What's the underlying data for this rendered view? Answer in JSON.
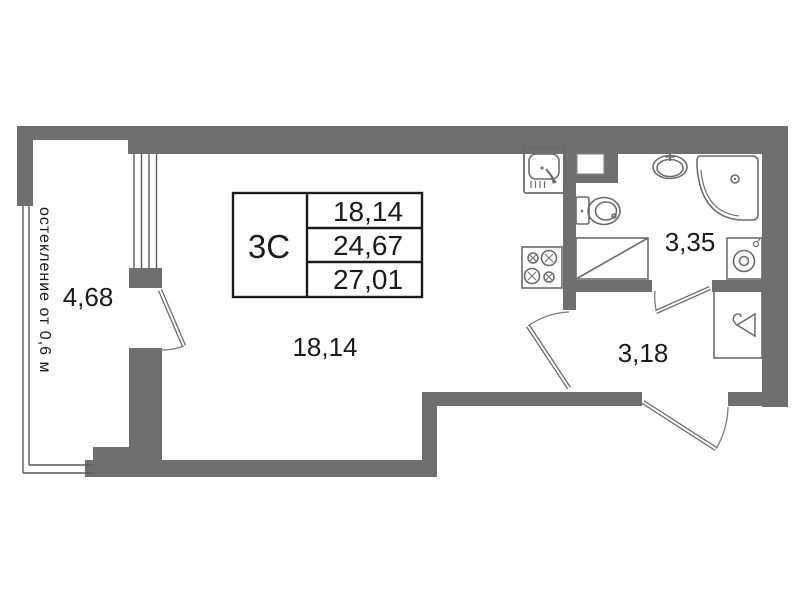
{
  "unit": {
    "code": "3С",
    "area_rows": [
      "18,14",
      "24,67",
      "27,01"
    ]
  },
  "rooms": {
    "balcony": "4,68",
    "living_room": "18,14",
    "bathroom": "3,35",
    "hallway": "3,18"
  },
  "notes": {
    "glazing": "остекление от 0,6 м"
  },
  "colors": {
    "wall": "#6f6f6f",
    "fixture_line": "#6b6b6b",
    "table_border": "#1a1a1a",
    "text": "#1a1a1a",
    "background": "#ffffff"
  }
}
